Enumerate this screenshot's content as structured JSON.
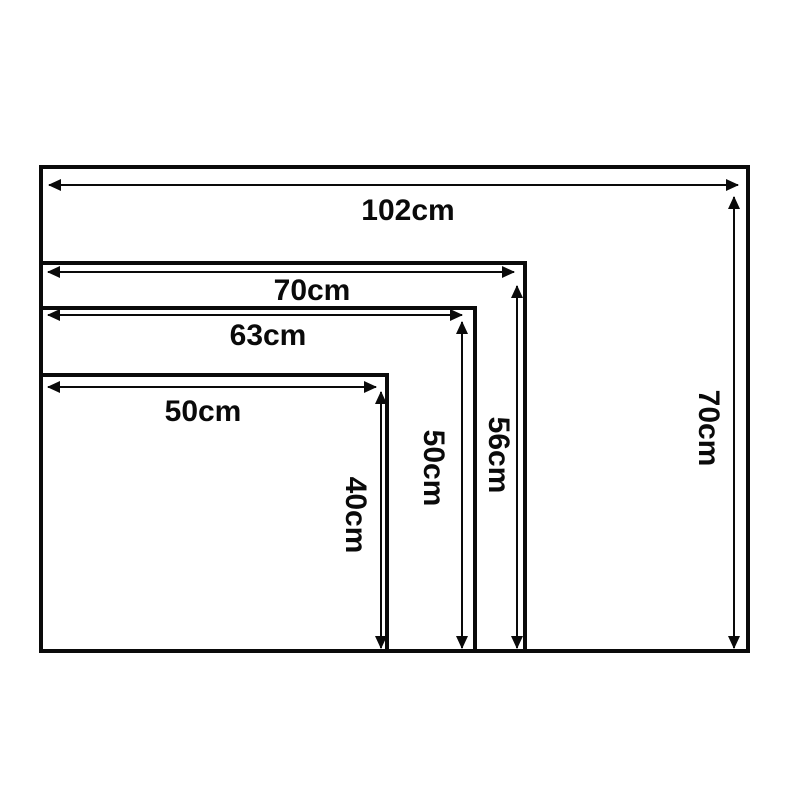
{
  "diagram": {
    "type": "nested-size-comparison",
    "unit": "cm",
    "colors": {
      "line": "#0a0a0a",
      "text": "#0a0a0a",
      "background": "#ffffff"
    },
    "rects": [
      {
        "name": "size-102x70",
        "width_cm": 102,
        "height_cm": 70,
        "width_label": "102cm",
        "height_label": "70cm"
      },
      {
        "name": "size-70x56",
        "width_cm": 70,
        "height_cm": 56,
        "width_label": "70cm",
        "height_label": "56cm"
      },
      {
        "name": "size-63x50",
        "width_cm": 63,
        "height_cm": 50,
        "width_label": "63cm",
        "height_label": "50cm"
      },
      {
        "name": "size-50x40",
        "width_cm": 50,
        "height_cm": 40,
        "width_label": "50cm",
        "height_label": "40cm"
      }
    ]
  }
}
